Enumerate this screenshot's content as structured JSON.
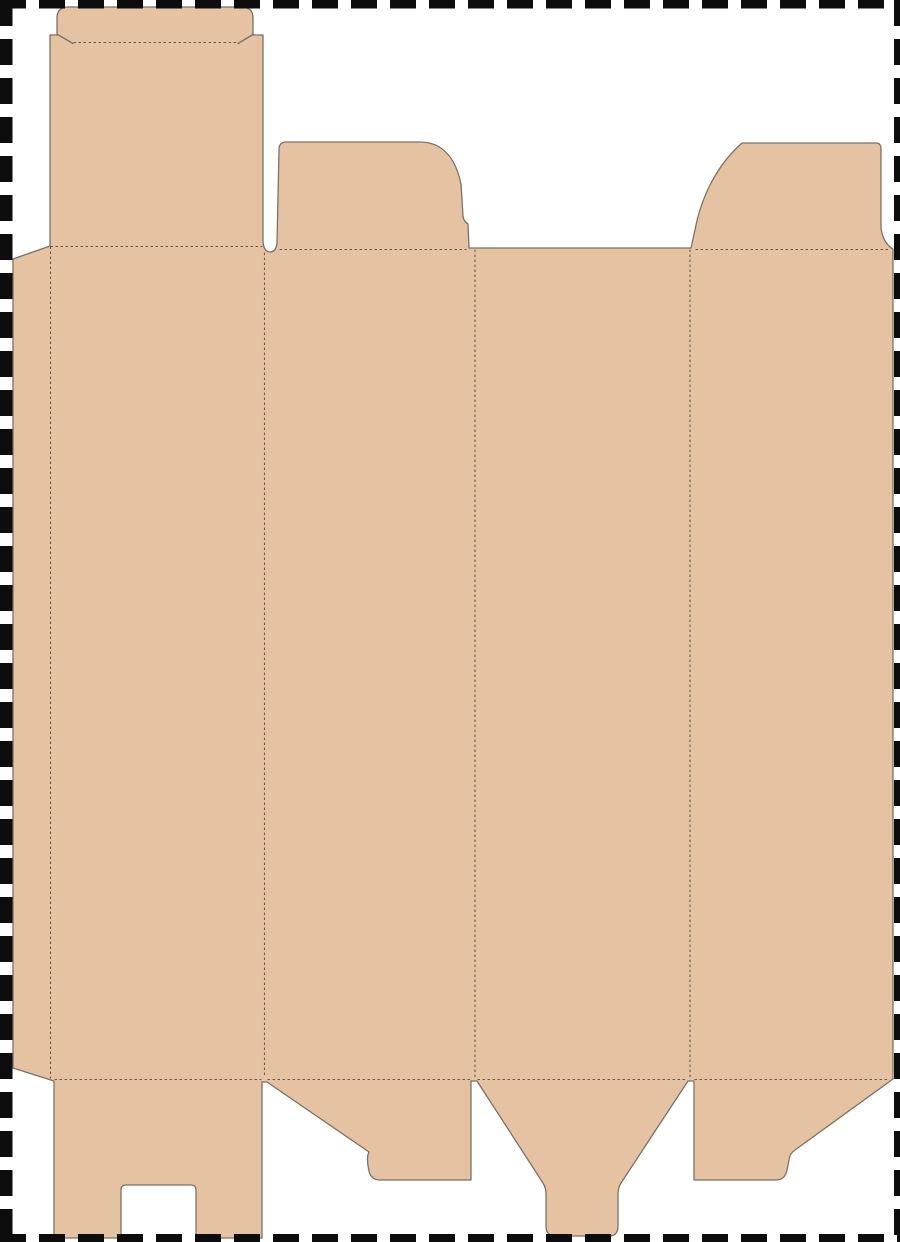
{
  "artboard": {
    "width": 900,
    "height": 1242,
    "background": "#ffffff",
    "border_color": "#0d0d0d",
    "border_dash": "26 13",
    "border_lines": [
      {
        "x1": 0,
        "y1": 4,
        "x2": 900,
        "y2": 4,
        "w": 9
      },
      {
        "x1": 6,
        "y1": 0,
        "x2": 6,
        "y2": 1242,
        "w": 13
      },
      {
        "x1": 897.5,
        "y1": 0,
        "x2": 897.5,
        "y2": 1242,
        "w": 7
      },
      {
        "x1": 0,
        "y1": 1238,
        "x2": 900,
        "y2": 1238,
        "w": 8
      }
    ]
  },
  "dieline": {
    "fill": "#e5c2a1",
    "cut_color": "#7a7268",
    "fold_color": "#4c443e",
    "outline_path": "M 13 259 L 50 246 L 50 35 L 57 35 L 57 18 Q 57 7 69 7 L 241 7 Q 253 7 253 18 L 253 35 L 263 35 L 263 242 Q 264 252 270 252 Q 276 252 277 243 L 279 150 Q 279 142 286 142 L 420 142 C 444 142 456 160 461 184 L 463 216 Q 464 222 468 224 L 469 248 L 691 248 L 695 230 C 701 198 716 166 742 143 L 876 143 Q 881 143 881 149 L 881 228 Q 883 243 893 249 L 893 1079 L 795 1150 Q 790 1153 789 1160 L 787 1170 Q 785 1180 776 1180 L 694 1180 L 694 1081 L 688 1081 L 621 1183 Q 618 1188 618 1194 L 618 1226 Q 618 1236 609 1236 L 555 1236 Q 546 1236 546 1226 L 546 1194 Q 546 1188 543 1183 L 477 1081 L 471 1081 L 471 1180 L 380 1180 Q 371 1180 369 1171 Q 366 1157 369 1152 L 267 1082 L 262 1082 L 262 1238 L 196 1238 L 196 1190 Q 196 1185 191 1185 L 126 1185 Q 121 1185 121 1190 L 121 1238 L 54 1238 L 54 1081 L 13 1068 Z",
    "fold_lines": [
      {
        "part": "glue-flap-fold",
        "x1": 50.5,
        "y1": 247,
        "x2": 50.5,
        "y2": 1078
      },
      {
        "part": "panel-1-2-fold",
        "x1": 264.5,
        "y1": 253,
        "x2": 264.5,
        "y2": 1078
      },
      {
        "part": "panel-2-3-fold",
        "x1": 475,
        "y1": 250,
        "x2": 475,
        "y2": 1078
      },
      {
        "part": "panel-3-4-fold",
        "x1": 690,
        "y1": 250,
        "x2": 690,
        "y2": 1078
      },
      {
        "part": "top-fold-panel-1",
        "x1": 51,
        "y1": 246.5,
        "x2": 262,
        "y2": 246.5
      },
      {
        "part": "top-fold-panel-2",
        "x1": 280,
        "y1": 249.5,
        "x2": 466,
        "y2": 249.5
      },
      {
        "part": "top-fold-panel-4",
        "x1": 696,
        "y1": 249.5,
        "x2": 890,
        "y2": 249.5
      },
      {
        "part": "bottom-fold-panel-1",
        "x1": 55,
        "y1": 1079.5,
        "x2": 261,
        "y2": 1079.5
      },
      {
        "part": "bottom-fold-panel-2",
        "x1": 268,
        "y1": 1079.5,
        "x2": 470,
        "y2": 1079.5
      },
      {
        "part": "bottom-fold-panel-3",
        "x1": 478,
        "y1": 1079.5,
        "x2": 687,
        "y2": 1079.5
      },
      {
        "part": "bottom-fold-panel-4",
        "x1": 695,
        "y1": 1079.5,
        "x2": 890,
        "y2": 1079.5
      },
      {
        "part": "tuck-flap-score",
        "x1": 74,
        "y1": 42.5,
        "x2": 239,
        "y2": 42.5
      }
    ],
    "cut_ticks": [
      {
        "part": "tuck-nick-left",
        "x1": 57.5,
        "y1": 34.5,
        "x2": 73,
        "y2": 43.5
      },
      {
        "part": "tuck-nick-right",
        "x1": 253,
        "y1": 34.5,
        "x2": 238,
        "y2": 43.5
      }
    ],
    "parts": [
      {
        "name": "glue-flap"
      },
      {
        "name": "panel-1"
      },
      {
        "name": "panel-2"
      },
      {
        "name": "panel-3"
      },
      {
        "name": "panel-4"
      },
      {
        "name": "tuck-top-flap"
      },
      {
        "name": "dust-flap-top-panel-2"
      },
      {
        "name": "dust-flap-top-panel-4"
      },
      {
        "name": "lock-slot-bottom-flap"
      },
      {
        "name": "bottom-tuck-tongue"
      },
      {
        "name": "dust-flap-bottom-panel-2"
      },
      {
        "name": "dust-flap-bottom-panel-4"
      }
    ]
  }
}
